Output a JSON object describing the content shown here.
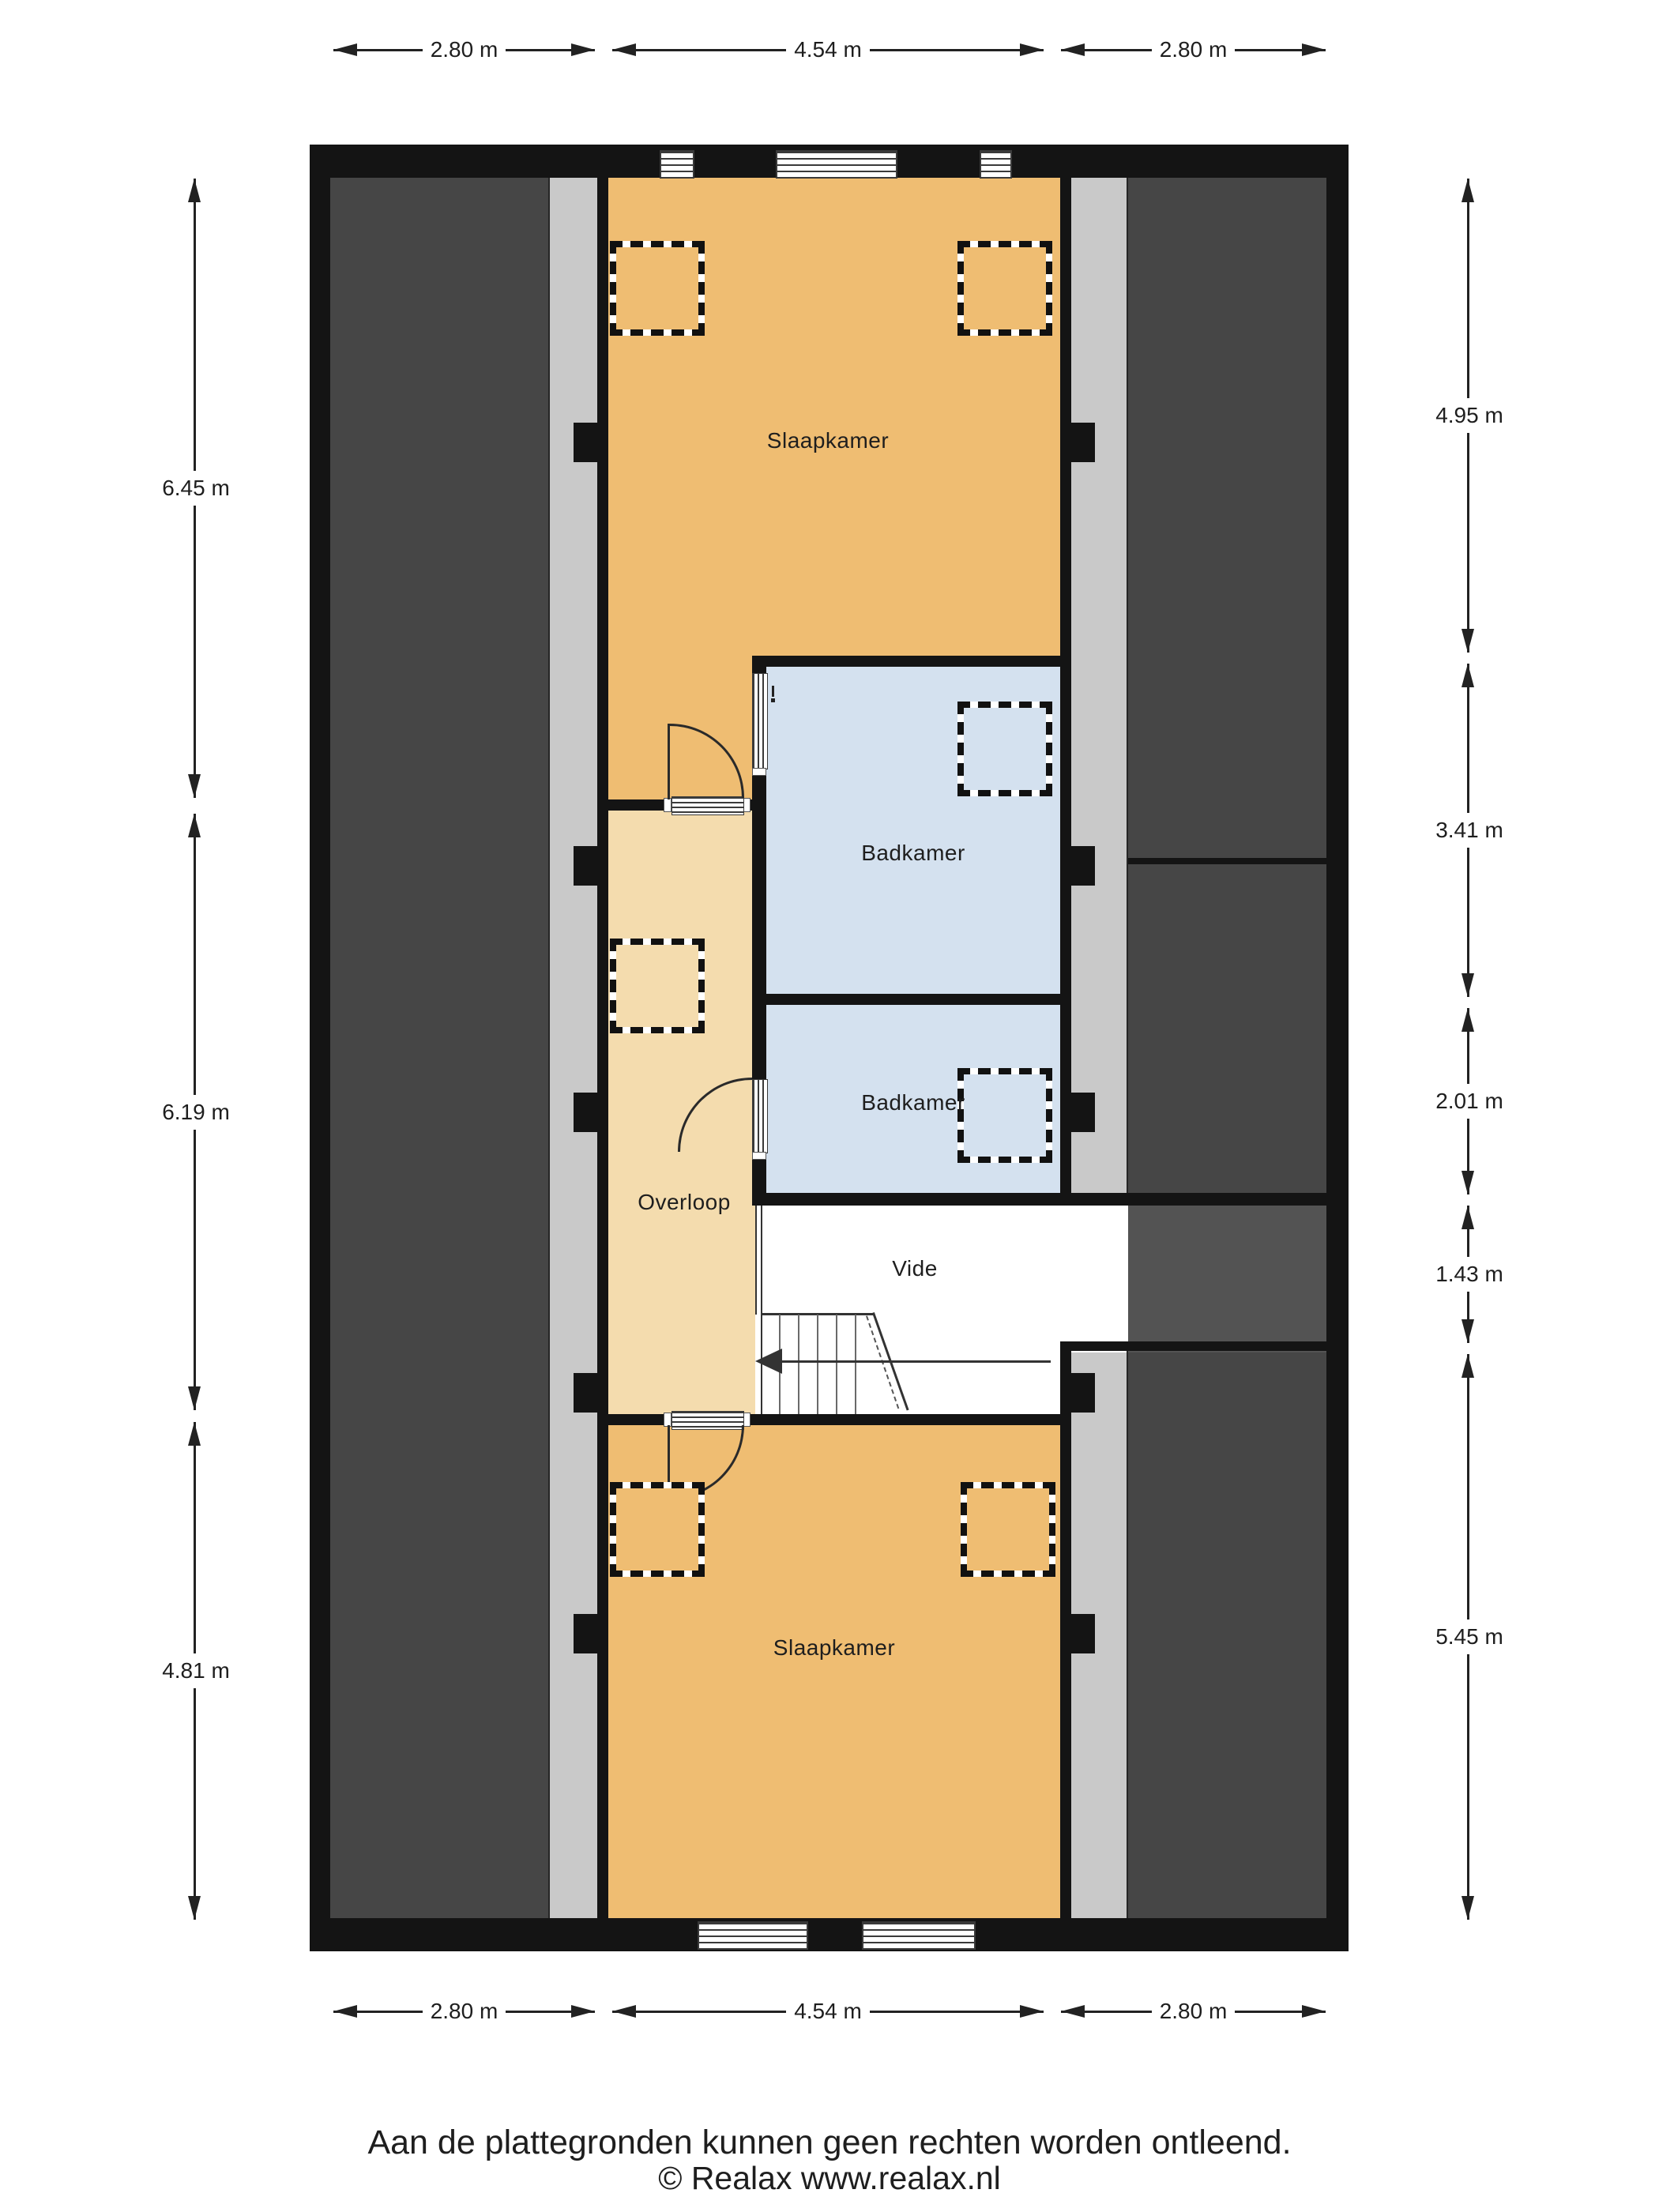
{
  "colors": {
    "wall": "#141414",
    "attic": "#464646",
    "attic-light": "#535353",
    "strip": "#c9c9c9",
    "room": "#efbd72",
    "hall": "#f4dcae",
    "bath": "#d4e1ef",
    "line": "#2a2a2a",
    "text": "#1e1e1e"
  },
  "plan": {
    "rooms": {
      "slaapkamer_top": "Slaapkamer",
      "badkamer_1": "Badkamer",
      "badkamer_2": "Badkamer",
      "overloop": "Overloop",
      "vide": "Vide",
      "slaapkamer_bottom": "Slaapkamer"
    },
    "dimensions": {
      "top": [
        "2.80 m",
        "4.54 m",
        "2.80 m"
      ],
      "bottom": [
        "2.80 m",
        "4.54 m",
        "2.80 m"
      ],
      "left": [
        "6.45 m",
        "6.19 m",
        "4.81 m"
      ],
      "right": [
        "4.95 m",
        "3.41 m",
        "2.01 m",
        "1.43 m",
        "5.45 m"
      ]
    }
  },
  "footer": {
    "disclaimer": "Aan de plattegronden kunnen geen rechten worden ontleend.",
    "copyright": "© Realax www.realax.nl"
  }
}
